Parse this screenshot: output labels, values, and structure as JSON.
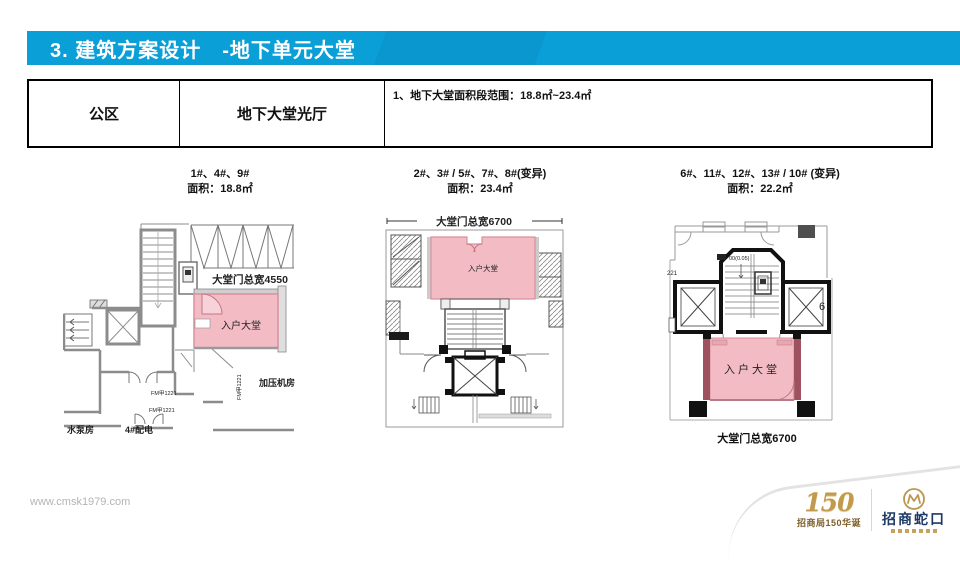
{
  "header": {
    "title": "3. 建筑方案设计　-地下单元大堂"
  },
  "table": {
    "cells": [
      "公区",
      "地下大堂光厅",
      "1、地下大堂面积段范围：18.8㎡~23.4㎡"
    ]
  },
  "plans": [
    {
      "caption_line1": "1#、4#、9#",
      "caption_line2": "面积：18.8㎡",
      "door_label": "大堂门总宽4550",
      "lobby": "入户大堂",
      "room_label": "加压机房",
      "door_tag1": "FM甲1221",
      "door_tag2": "FM甲1221",
      "door_tag3": "FM甲1221",
      "pump_label": "水泵房",
      "power_label": "4#配电"
    },
    {
      "caption_line1": "2#、3# / 5#、7#、8#(变异)",
      "caption_line2": "面积：23.4㎡",
      "door_label": "大堂门总宽6700",
      "lobby": "入户大堂"
    },
    {
      "caption_line1": "6#、11#、12#、13# / 10# (变异)",
      "caption_line2": "面积：22.2㎡",
      "door_label": "大堂门总宽6700",
      "lobby": "入户大堂",
      "elev_note": "00(0.05)",
      "note_left": "221",
      "note_right": "6"
    }
  ],
  "footer": {
    "url": "www.cmsk1979.com",
    "anniv_number": "150",
    "anniv_text": "招商局150华诞",
    "brand_name": "招商蛇口"
  },
  "colors": {
    "header_blue": "#0b9fd8",
    "header_accent": "#0d68ad",
    "lobby_pink": "#f3bcc5",
    "lobby_pink_border": "#d9909d",
    "brand_gold": "#bd9750",
    "brand_navy": "#1d3a66"
  }
}
